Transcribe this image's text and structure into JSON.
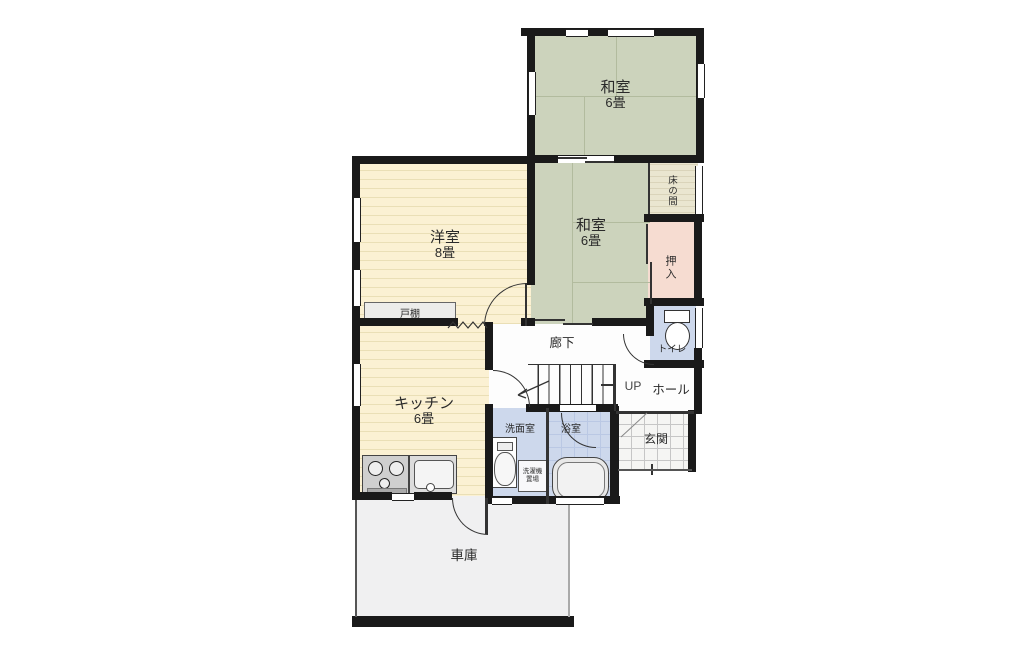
{
  "colors": {
    "wall": "#1a1a1a",
    "text": "#2a2a2a",
    "tatami": "#ccd3bc",
    "tatami_line": "#b2bb9e",
    "wood": "#fbf1d3",
    "wood_line": "#eadfb6",
    "tokonoma": "#eae6d0",
    "tokonoma_line": "#dad4ba",
    "closet": "#f6dcd1",
    "water": "#cdd8ec",
    "tile_line": "#bac8e4",
    "genkan_tile": "#f5f5f3",
    "genkan_line": "#c6c6c6",
    "garage": "#f0f0f1",
    "hall": "#fdfdfd"
  },
  "rooms": {
    "washitsu_top": {
      "name": "和室",
      "size": "6畳"
    },
    "washitsu_mid": {
      "name": "和室",
      "size": "6畳"
    },
    "yoshitsu": {
      "name": "洋室",
      "size": "8畳"
    },
    "kitchen": {
      "name": "キッチン",
      "size": "6畳"
    },
    "tokonoma": "床の間",
    "oshiire": "押入",
    "toilet": "トイレ",
    "todana": "戸棚",
    "rouka": "廊下",
    "up": "UP",
    "hall": "ホール",
    "senmenshitsu": "洗面室",
    "sentakuki_okiba": "洗濯機置場",
    "yokushitsu": "浴室",
    "genkan": "玄関",
    "shako": "車庫"
  }
}
